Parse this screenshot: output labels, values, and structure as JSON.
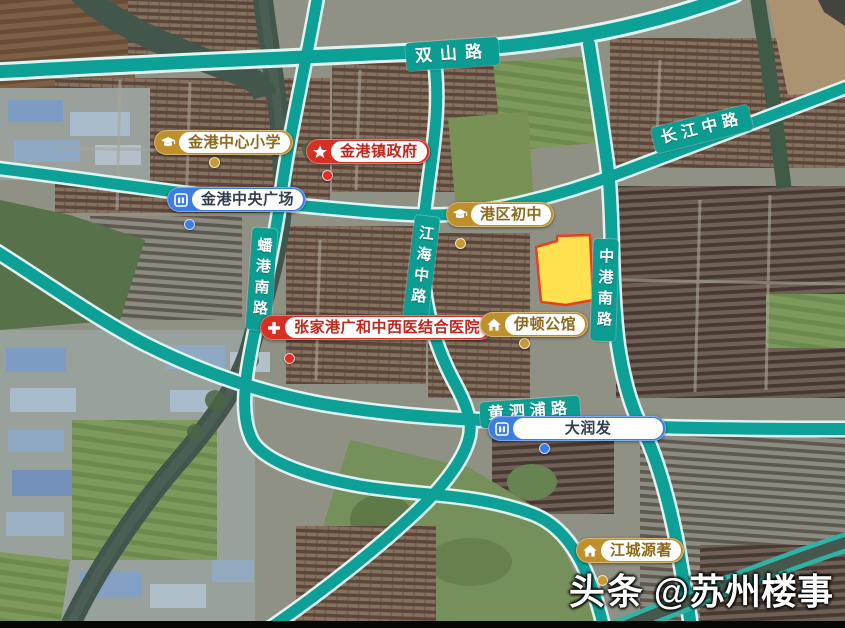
{
  "map": {
    "road_labels": [
      {
        "id": "shuangshan-road",
        "label": "双山路",
        "orientation": "horizontal"
      },
      {
        "id": "changjiang-middle-road",
        "label": "长江中路",
        "orientation": "horizontal"
      },
      {
        "id": "pangang-south-road",
        "label": "蟠港南路",
        "orientation": "vertical"
      },
      {
        "id": "jianghai-middle-road",
        "label": "江海中路",
        "orientation": "vertical"
      },
      {
        "id": "zhonggang-south-road",
        "label": "中港南路",
        "orientation": "vertical"
      },
      {
        "id": "huangsipu-road",
        "label": "黄泗浦路",
        "orientation": "horizontal"
      }
    ],
    "pois": [
      {
        "id": "jingang-central-primary-school",
        "label": "金港中心小学",
        "category": "school",
        "icon": "graduation-cap-icon",
        "pill_color": "#BF8F2B"
      },
      {
        "id": "jingang-town-government",
        "label": "金港镇政府",
        "category": "government",
        "icon": "star-icon",
        "pill_color": "#D62F23"
      },
      {
        "id": "jingang-central-plaza",
        "label": "金港中央广场",
        "category": "landmark",
        "icon": "building-icon",
        "pill_color": "#3C7DE2"
      },
      {
        "id": "gangqu-junior-high-school",
        "label": "港区初中",
        "category": "school",
        "icon": "graduation-cap-icon",
        "pill_color": "#BF8F2B"
      },
      {
        "id": "zhangjiagang-guanghe-integrated-hospital",
        "label": "张家港广和中西医结合医院",
        "category": "hospital",
        "icon": "cross-icon",
        "pill_color": "#D62F23"
      },
      {
        "id": "yidun-mansion",
        "label": "伊顿公馆",
        "category": "residence",
        "icon": "house-icon",
        "pill_color": "#BF8F2B"
      },
      {
        "id": "rt-mart",
        "label": "大润发",
        "category": "shopping",
        "icon": "building-icon",
        "pill_color": "#3C7DE2"
      },
      {
        "id": "jiangcheng-yuanzhu",
        "label": "江城源著",
        "category": "residence",
        "icon": "house-icon",
        "pill_color": "#BF8F2B"
      }
    ],
    "highlighted_parcel": {
      "fill_color": "#FFE14F",
      "border_color": "#E8401C"
    },
    "road_color": "#0DA096"
  },
  "watermark": {
    "brand": "头条",
    "handle": "@苏州楼事"
  }
}
